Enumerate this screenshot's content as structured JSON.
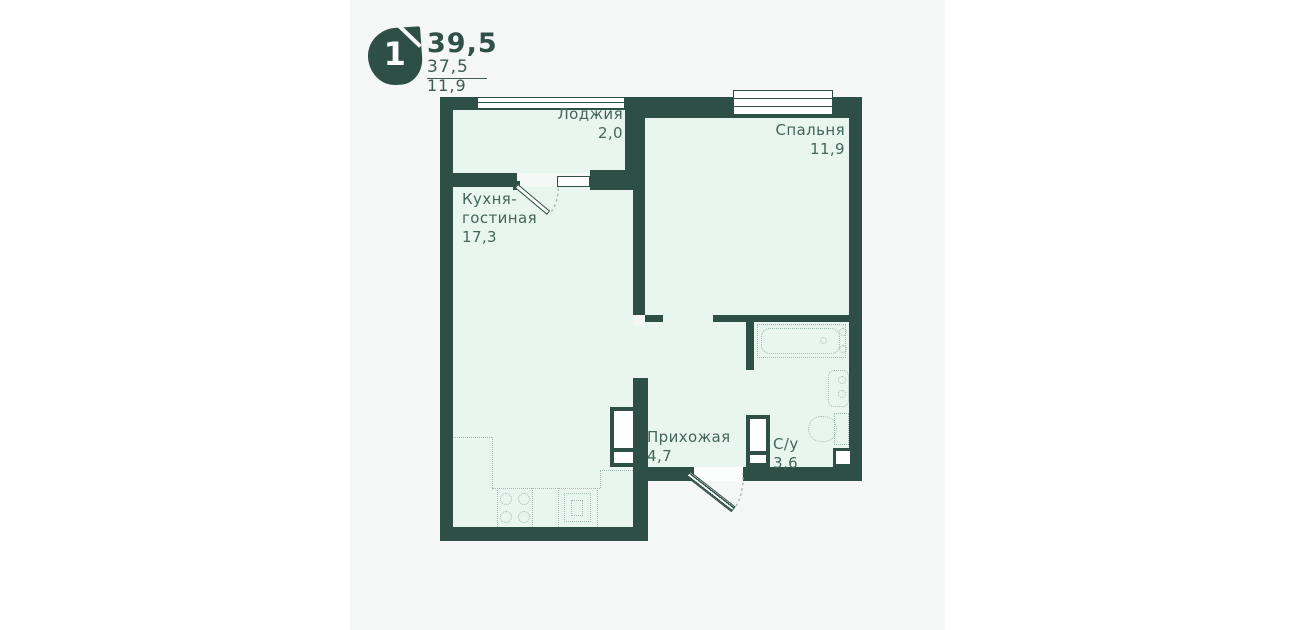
{
  "header": {
    "rooms_badge": "1",
    "total_area": "39,5",
    "living_area": "37,5",
    "kitchen_area": "11,9"
  },
  "plan": {
    "wall_color": "#2d4f46",
    "floor_color": "#e9f6ef",
    "fixture_color": "#9fbab0",
    "label_color": "#44655c",
    "card_color": "#f5f6f6",
    "rooms": [
      {
        "name": "Лоджия",
        "area": "2,0"
      },
      {
        "name": "Спальня",
        "area": "11,9"
      },
      {
        "name_line1": "Кухня-",
        "name_line2": "гостиная",
        "area": "17,3"
      },
      {
        "name": "Прихожая",
        "area": "4,7"
      },
      {
        "name": "С/у",
        "area": "3,6"
      }
    ]
  }
}
